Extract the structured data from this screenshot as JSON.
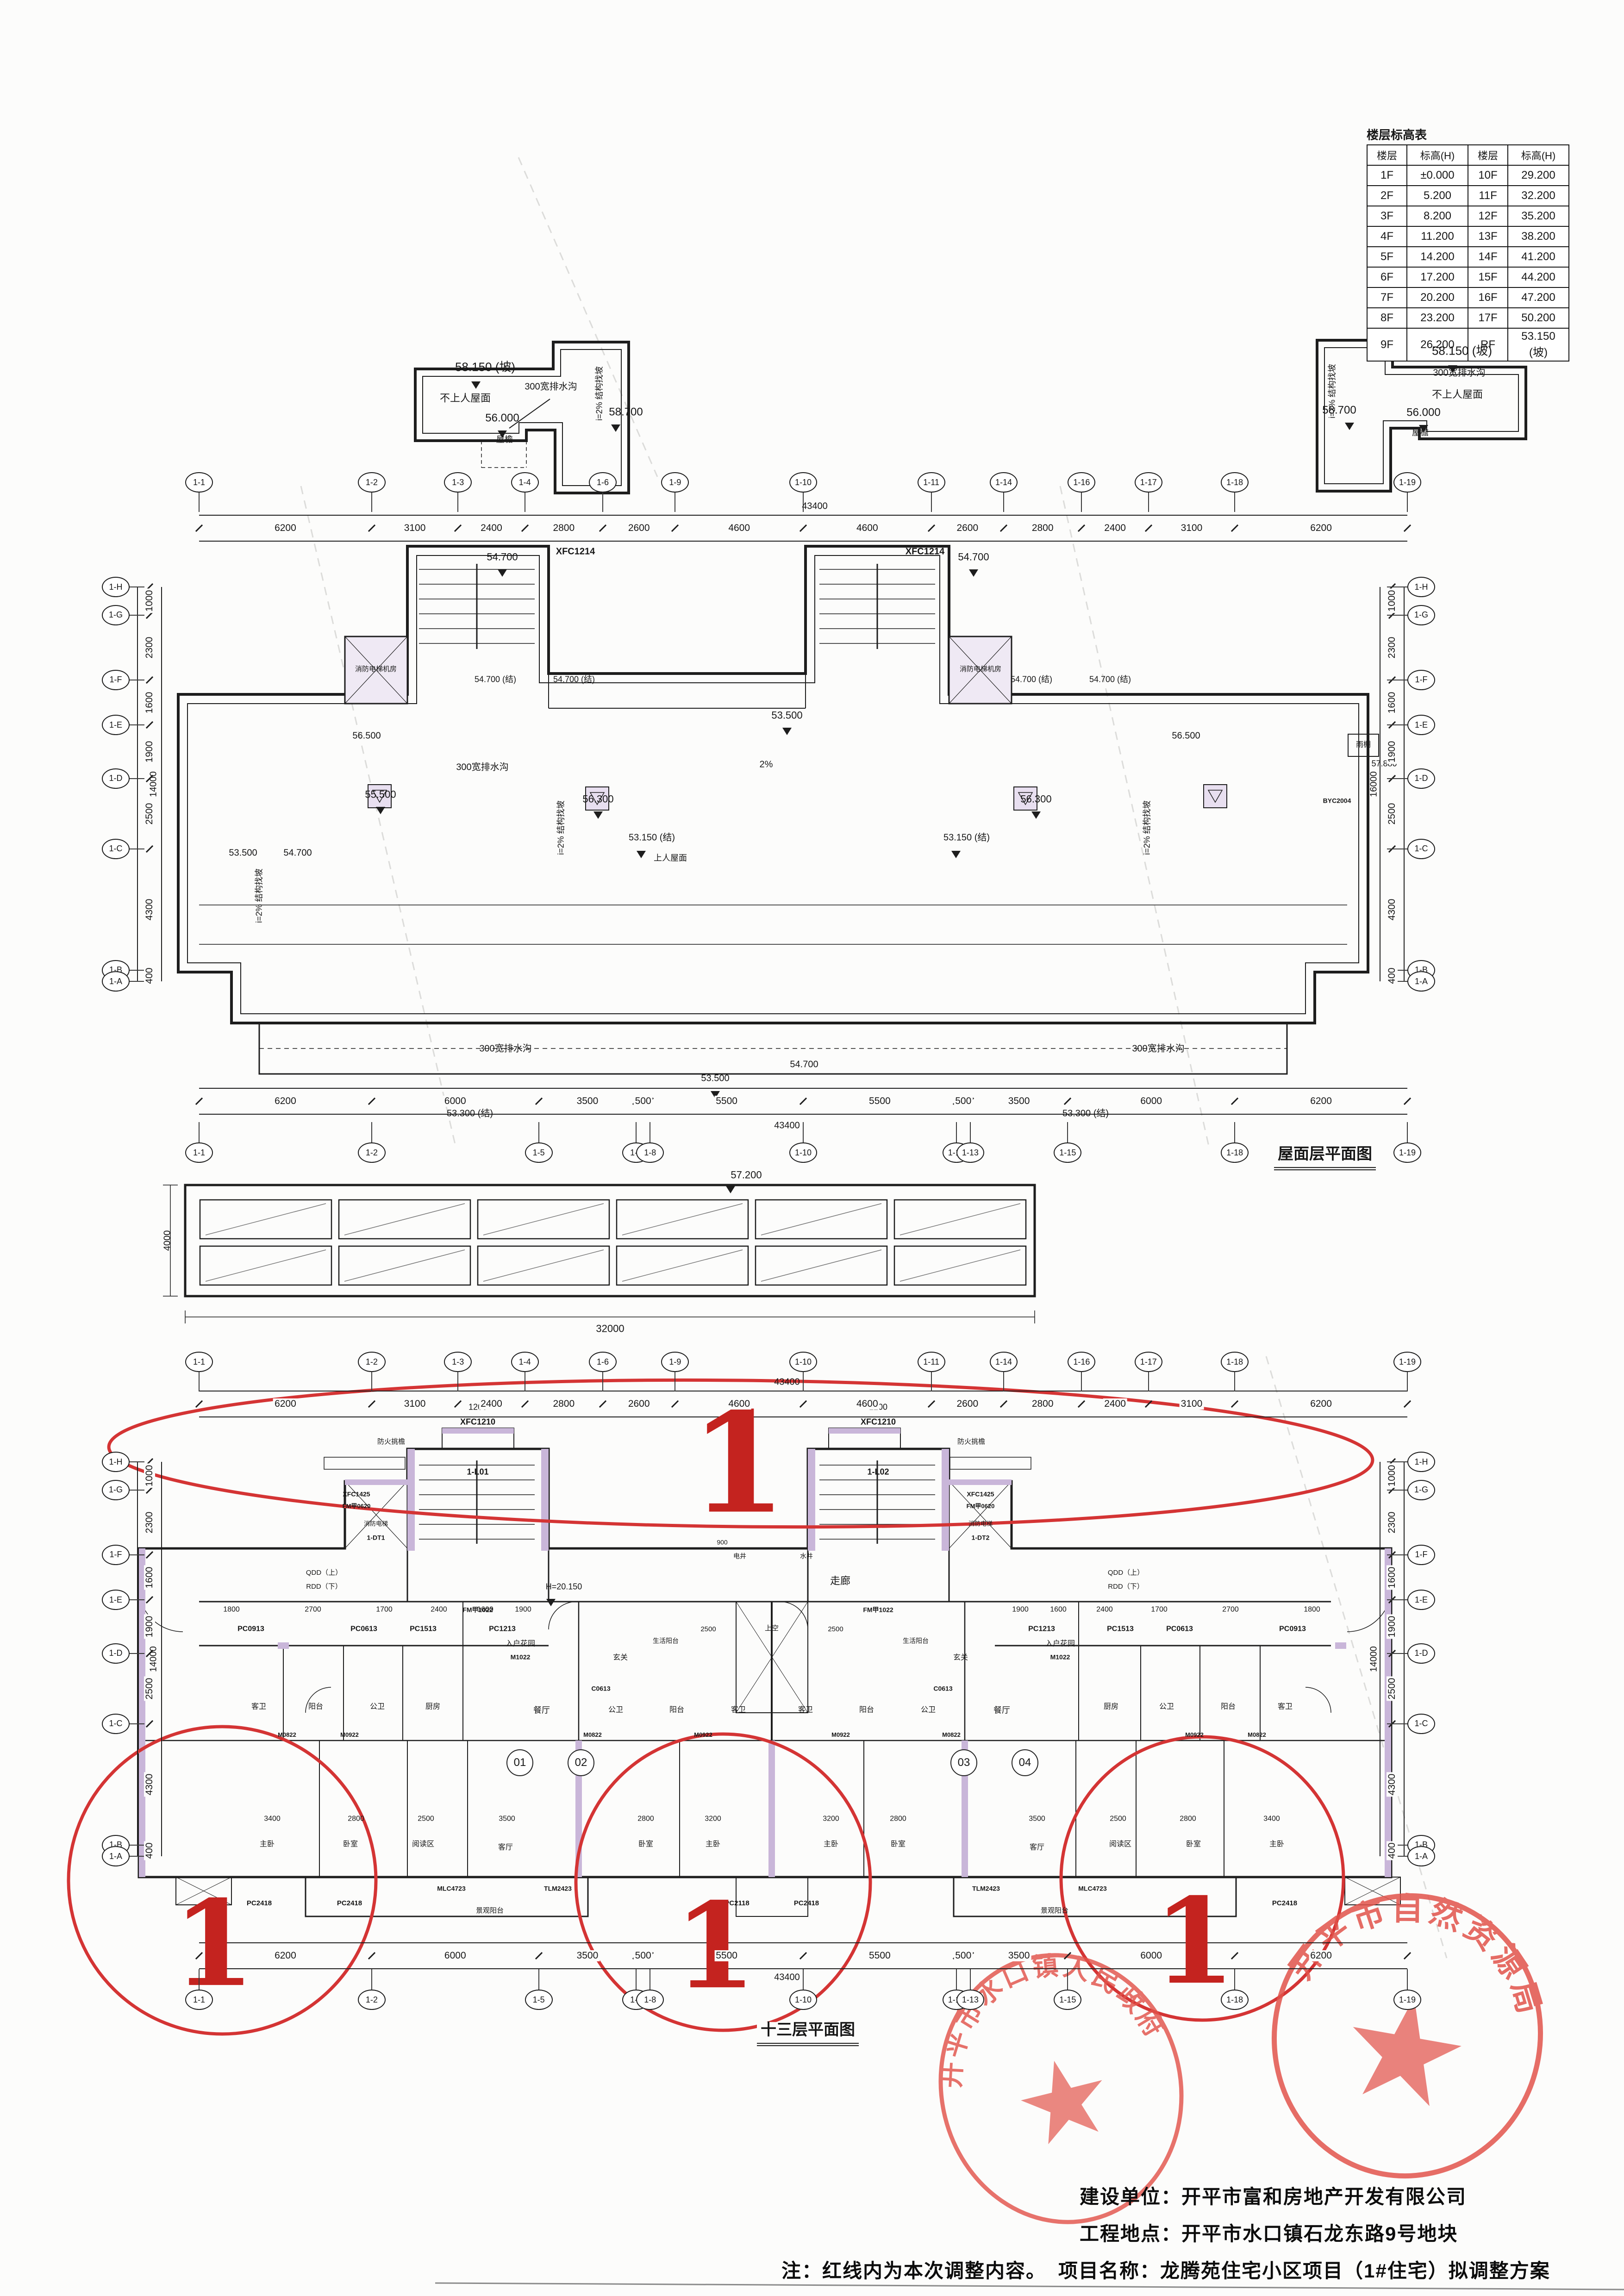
{
  "titles": {
    "roof": "屋面层平面图",
    "floor13": "十三层平面图",
    "table": "楼层标高表"
  },
  "project": {
    "owner": "建设单位：开平市富和房地产开发有限公司",
    "site": "工程地点：开平市水口镇石龙东路9号地块",
    "name": "项目名称：龙腾苑住宅小区项目（1#住宅）拟调整方案",
    "note": "注：红线内为本次调整内容。"
  },
  "stamps": {
    "left": "开平市水口镇人民政府",
    "right": "开平市自然资源局"
  },
  "revision_mark": "1",
  "elevation_table": {
    "header": [
      "楼层",
      "标高(H)",
      "楼层",
      "标高(H)"
    ],
    "rows": [
      [
        "1F",
        "±0.000",
        "10F",
        "29.200"
      ],
      [
        "2F",
        "5.200",
        "11F",
        "32.200"
      ],
      [
        "3F",
        "8.200",
        "12F",
        "35.200"
      ],
      [
        "4F",
        "11.200",
        "13F",
        "38.200"
      ],
      [
        "5F",
        "14.200",
        "14F",
        "41.200"
      ],
      [
        "6F",
        "17.200",
        "15F",
        "44.200"
      ],
      [
        "7F",
        "20.200",
        "16F",
        "47.200"
      ],
      [
        "8F",
        "23.200",
        "17F",
        "50.200"
      ],
      [
        "9F",
        "26.200",
        "RF",
        "53.150 (坡)"
      ]
    ]
  },
  "grids": {
    "h_top": {
      "bubbles": [
        "1-1",
        "1-2",
        "1-3",
        "1-4",
        "1-6",
        "1-9",
        "1-10",
        "1-11",
        "1-14",
        "1-16",
        "1-17",
        "1-18",
        "1-19"
      ],
      "dims": [
        "6200",
        "3100",
        "2400",
        "2800",
        "2600",
        "4600",
        "4600",
        "2600",
        "2800",
        "2400",
        "3100",
        "6200"
      ]
    },
    "h_bot": {
      "bubbles": [
        "1-1",
        "1-2",
        "1-5",
        "1-7",
        "1-8",
        "1-10",
        "1-12",
        "1-13",
        "1-15",
        "1-18",
        "1-19"
      ],
      "dims": [
        "6200",
        "6000",
        "3500",
        "500",
        "5500",
        "5500",
        "500",
        "3500",
        "6000",
        "6200"
      ]
    },
    "v_side": {
      "bubbles": [
        "1-H",
        "1-G",
        "1-F",
        "1-E",
        "1-D",
        "1-C",
        "1-B",
        "1-A"
      ],
      "dims": [
        "1000",
        "2300",
        "1600",
        "1900",
        "2500",
        "4300",
        "400"
      ]
    },
    "h_top_total": "43400",
    "h_bot_total": "43400",
    "v_total": "14000",
    "v_total_r": "16000"
  },
  "lbl": {
    "e58150": "58.150 (坡)",
    "no_access_roof": "不上人屋面",
    "gutter300": "300宽排水沟",
    "e56000": "56.000",
    "e58700": "58.700",
    "eave": "屋檐",
    "i2slope": "i=2% 结构找坡",
    "e54700": "54.700",
    "e54700j": "54.700 (结)",
    "xfc1214": "XFC1214",
    "fire_elev_room": "消防电梯机房",
    "e53150j": "53.150 (结)",
    "access_roof": "上人屋面",
    "e53500": "53.500",
    "pct2": "2%",
    "e55500": "55.500",
    "e56300": "56.300",
    "e56500": "56.500",
    "e53300j": "53.300 (结)",
    "e57880": "57.880",
    "canopy": "雨棚",
    "byc2004": "BYC2004",
    "e57200": "57.200",
    "d4000": "4000",
    "d32000": "32000",
    "d1200": "1200",
    "xfc1210": "XFC1210",
    "fire_eave": "防火挑檐",
    "l01": "1-L01",
    "l02": "1-L02",
    "xfc1425": "XFC1425",
    "fm0620": "FM甲0620",
    "fire_elev": "消防电梯",
    "dt1": "1-DT1",
    "dt2": "1-DT2",
    "fm1022": "FM甲1022",
    "qdd": "QDD（上）",
    "rdd": "RDD（下）",
    "corridor": "走廊",
    "e20150": "H=20.150",
    "d900": "900",
    "shaft_e": "电井",
    "shaft_w": "水井",
    "pc0913": "PC0913",
    "pc0613": "PC0613",
    "pc1513": "PC1513",
    "pc1213": "PC1213",
    "d1800": "1800",
    "d2700": "2700",
    "d1700": "1700",
    "d2400": "2400",
    "d1600": "1600",
    "d1900": "1900",
    "entry_garden": "入户花园",
    "m1022": "M1022",
    "foyer": "玄关",
    "life_balcony": "生活阳台",
    "d2500": "2500",
    "up_void": "上空",
    "c0613": "C0613",
    "bath_g": "客卫",
    "bath_p": "公卫",
    "balcony": "阳台",
    "kitchen": "厨房",
    "dining": "餐厅",
    "m0822": "M0822",
    "m0922": "M0922",
    "u01": "01",
    "u02": "02",
    "u03": "03",
    "u04": "04",
    "d3400": "3400",
    "d2800": "2800",
    "d3200": "3200",
    "d3500": "3500",
    "master": "主卧",
    "bed": "卧室",
    "reading": "阅读区",
    "living": "客厅",
    "pc2418": "PC2418",
    "pc2118": "PC2118",
    "mlc4723": "MLC4723",
    "tlm2423": "TLM2423",
    "view_balcony": "景观阳台"
  }
}
